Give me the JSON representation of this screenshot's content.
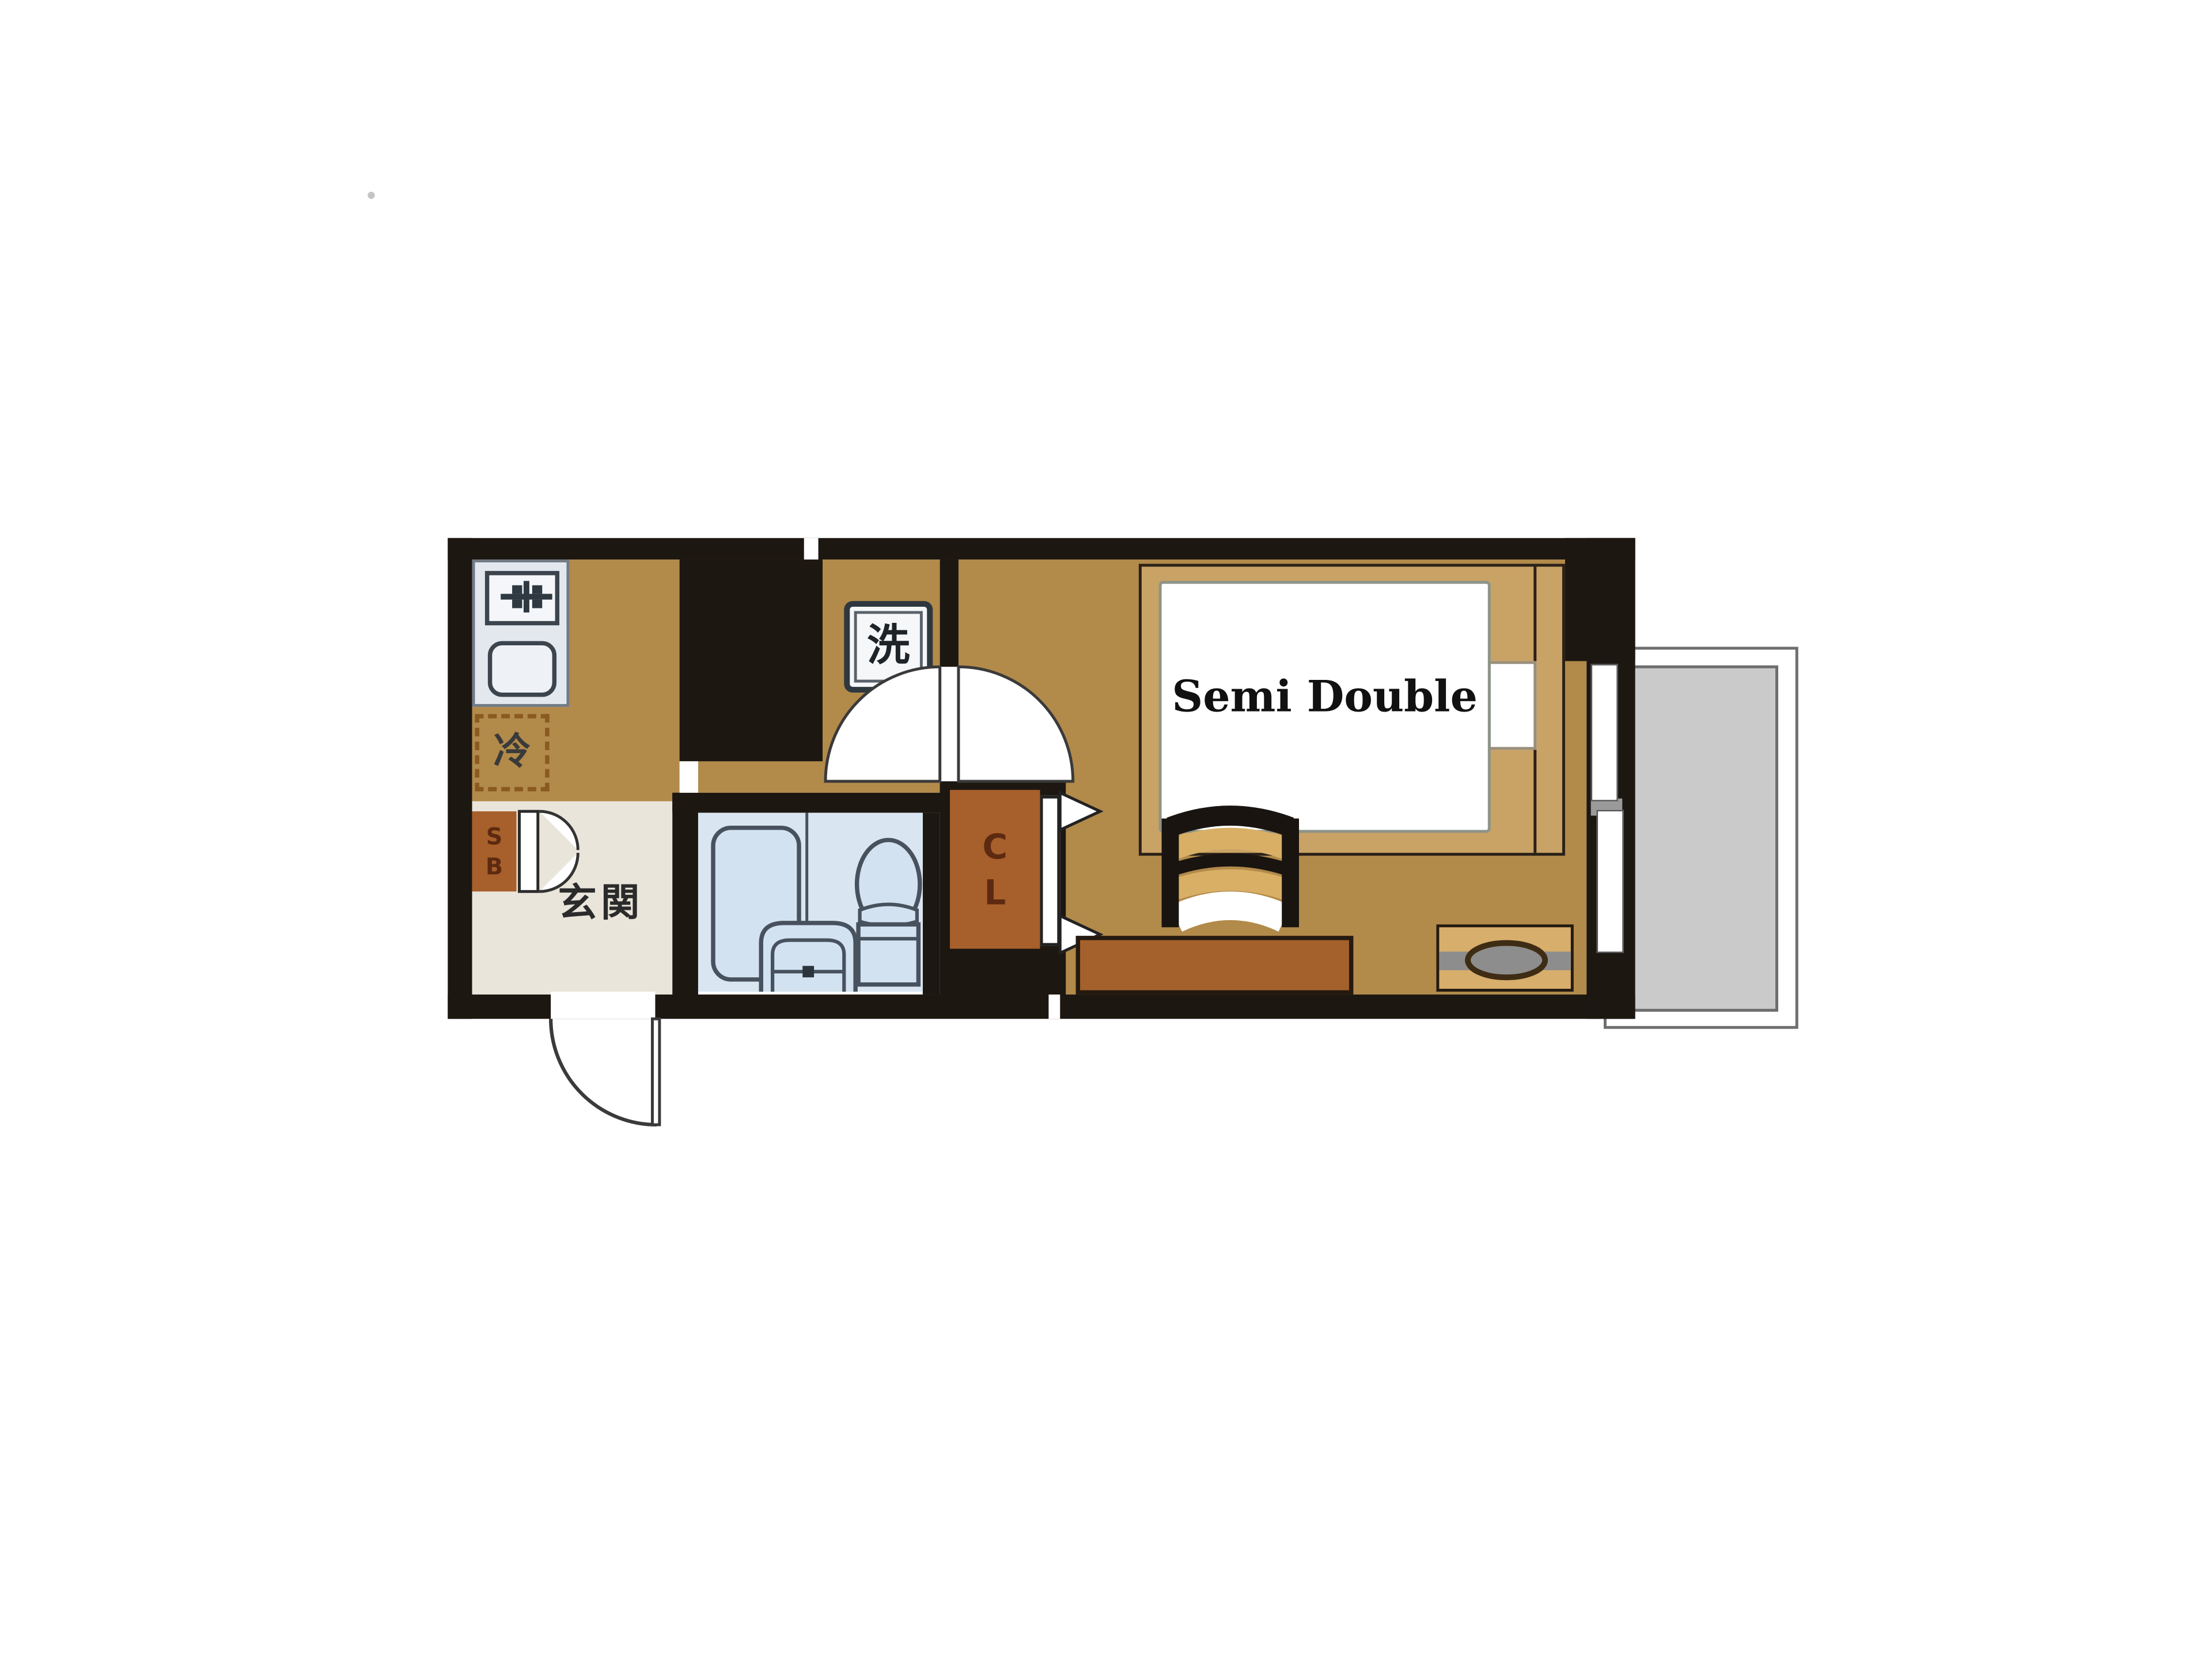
{
  "floorplan": {
    "type": "apartment-floor-plan-1K",
    "labels": {
      "genkan": "玄関",
      "refrigerator": "冷",
      "washer": "洗",
      "bed_size": "Semi Double",
      "shoebox": [
        "S",
        "B"
      ],
      "closet": [
        "C",
        "L"
      ]
    },
    "colors": {
      "wall": "#1d1712",
      "tan": "#b28a4a",
      "tan-light": "#c9a265",
      "genkan": "#eae5da",
      "bath": "#d9e6f2",
      "fixture": "#d3e2f0",
      "fixborder": "#47525e",
      "sienna": "#a75f2b",
      "tv": "#d7ae6b",
      "gray": "#8d8d8d",
      "balcony": "#cacaca",
      "balcborder": "#6e6e6e",
      "counter": "#e3e8ef",
      "dash": "#8a5a20",
      "text": "#2a2a2a",
      "cltext": "#5c2a10",
      "chairtan": "#d9af66",
      "line": "#333333"
    },
    "rooms": [
      {
        "name": "kitchen"
      },
      {
        "name": "hallway"
      },
      {
        "name": "genkan-entrance"
      },
      {
        "name": "bathroom"
      },
      {
        "name": "closet"
      },
      {
        "name": "main-room"
      },
      {
        "name": "balcony"
      }
    ]
  }
}
